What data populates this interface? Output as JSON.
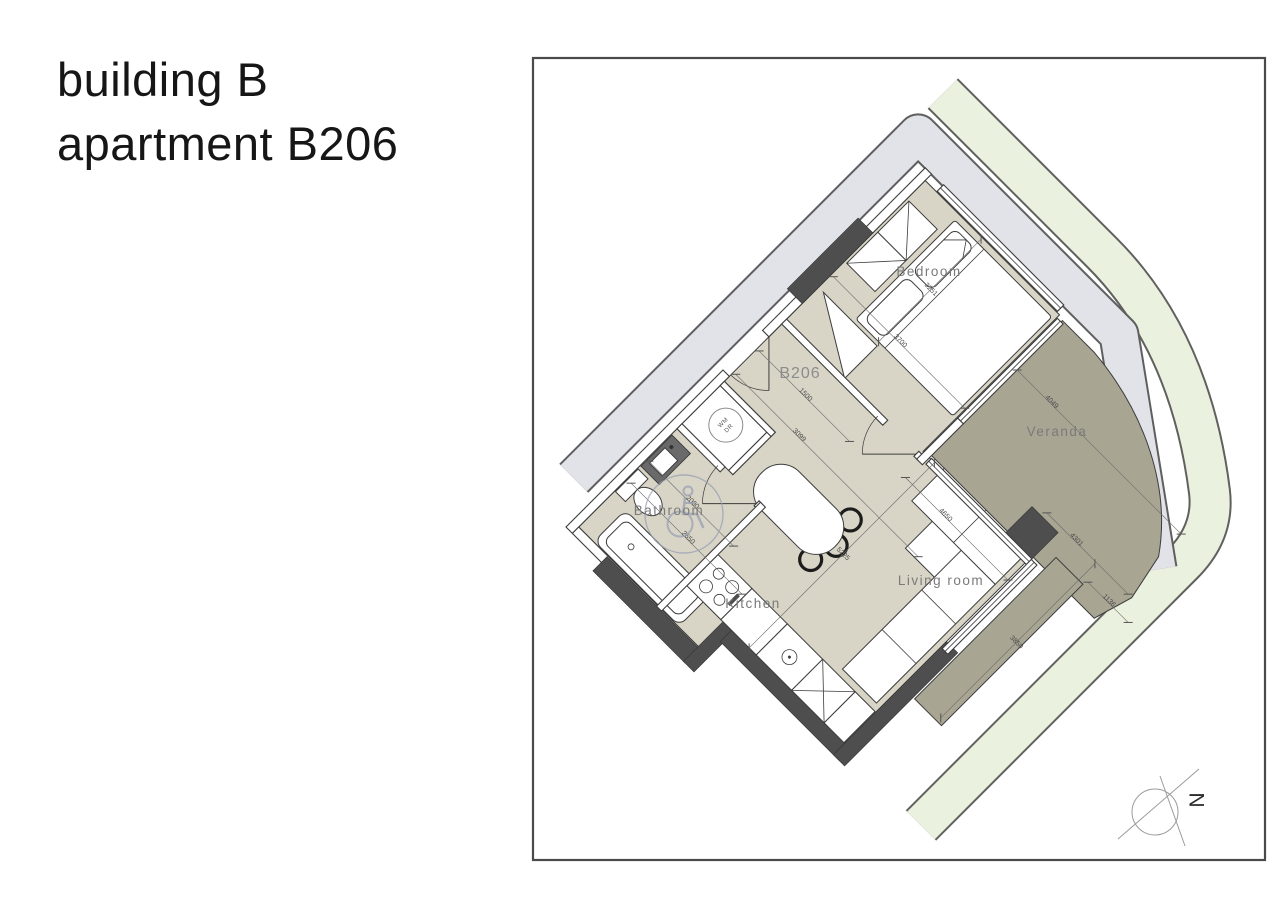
{
  "title": {
    "line1": "building B",
    "line2": "apartment B206"
  },
  "floor_plan": {
    "unit_label": "B206",
    "rooms": {
      "bedroom": "Bedroom",
      "bathroom": "Bathroom",
      "kitchen": "Kitchen",
      "living_room": "Living  room",
      "veranda": "Veranda"
    },
    "appliance_label": {
      "line1": "WM",
      "line2": "DR"
    },
    "north_label": "N",
    "dimensions": [
      "3251",
      "3700",
      "1500",
      "3099",
      "2000",
      "2650",
      "5225",
      "4650",
      "4049",
      "4301",
      "1136",
      "3850"
    ],
    "colors": {
      "floor": "#d8d4c6",
      "veranda": "#a9a593",
      "wall_dark": "#4e4e4e",
      "band_gray": "#e2e3e9",
      "band_green": "#eaf1de"
    }
  }
}
